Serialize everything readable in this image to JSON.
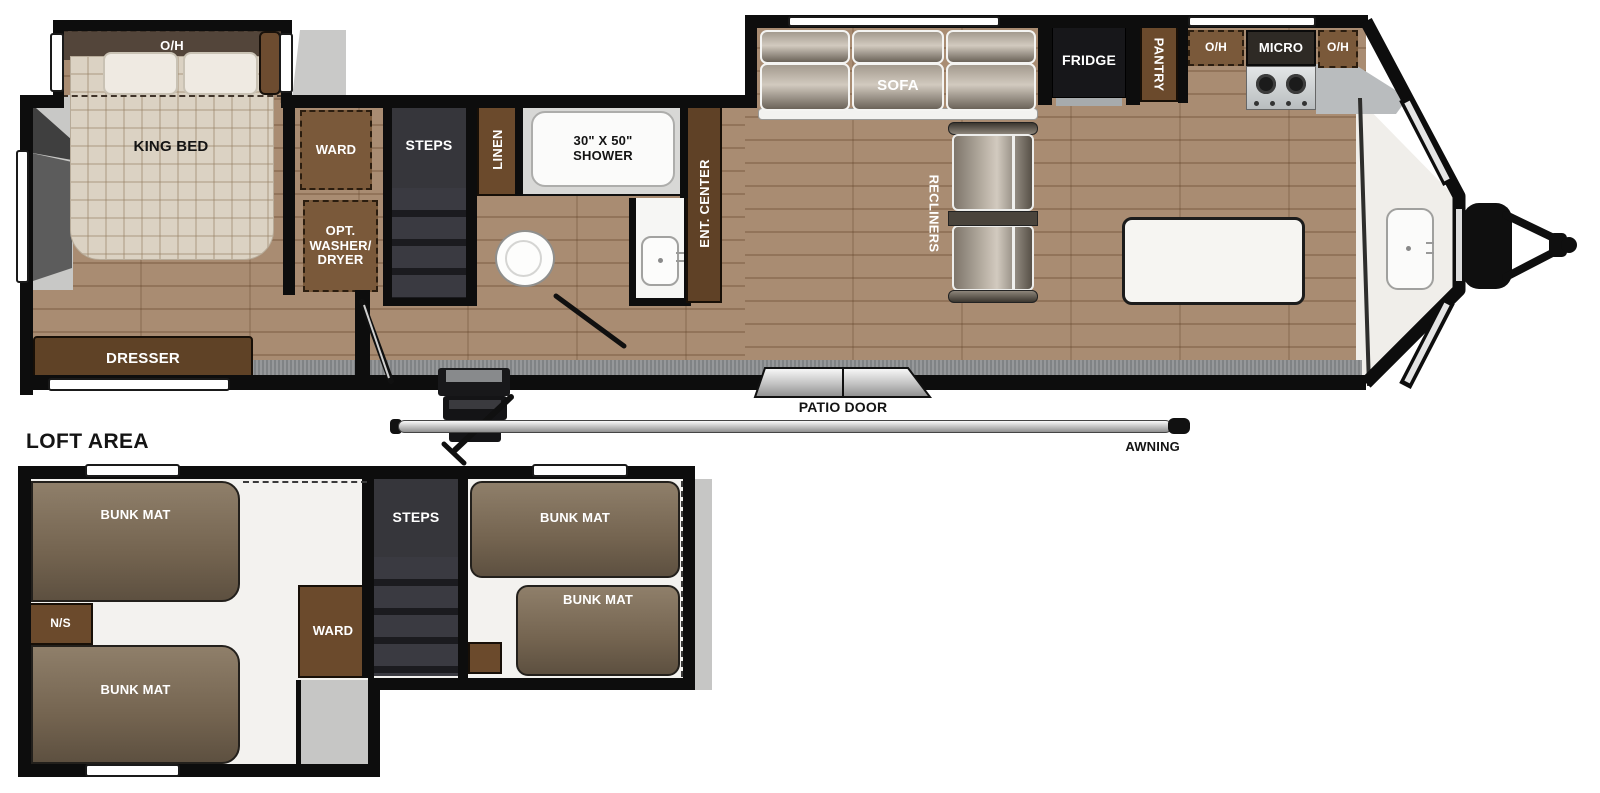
{
  "colors": {
    "wood_floor": "#a98c72",
    "wall": "#0d0d0d",
    "cabinet_brown": "#6b4a2c",
    "cabinet_dashed_brown": "#7a593a",
    "dark_unit": "#323237",
    "fridge_black": "#17171a",
    "white_fixture": "#f6f5f2",
    "ivory_floor": "#f0eeea",
    "carpet_gray": "#8f9294",
    "body_shade": "#c6c6c5",
    "bunk_mat_brown": "#7d6d5a"
  },
  "main_floor": {
    "bedroom": {
      "overhead": "O/H",
      "bed": "KING BED",
      "dresser": "DRESSER",
      "wardrobe": "WARD",
      "washer_dryer_line1": "OPT.",
      "washer_dryer_line2": "WASHER/",
      "washer_dryer_line3": "DRYER"
    },
    "hall": {
      "steps": "STEPS"
    },
    "bath": {
      "linen": "LINEN",
      "shower_line1": "30\" X 50\"",
      "shower_line2": "SHOWER"
    },
    "living": {
      "ent_center": "ENT. CENTER",
      "sofa": "SOFA",
      "recliners": "RECLINERS"
    },
    "kitchen": {
      "fridge": "FRIDGE",
      "pantry": "PANTRY",
      "overhead_left": "O/H",
      "micro": "MICRO",
      "overhead_right": "O/H"
    },
    "exterior": {
      "patio_door": "PATIO DOOR",
      "awning": "AWNING"
    }
  },
  "loft": {
    "heading": "LOFT AREA",
    "bunk_mats": [
      "BUNK MAT",
      "BUNK MAT",
      "BUNK MAT",
      "BUNK MAT"
    ],
    "nightstand": "N/S",
    "wardrobe": "WARD",
    "steps": "STEPS"
  }
}
